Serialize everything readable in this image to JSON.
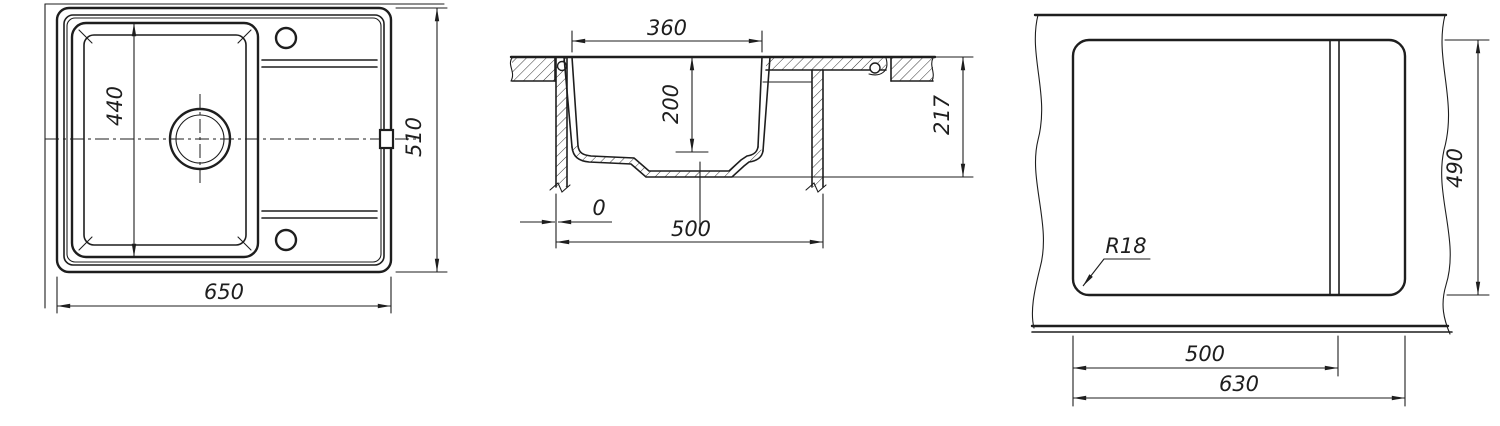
{
  "title": "Kitchen sink technical drawing - three views",
  "colors": {
    "ink": "#1e1e1e",
    "background": "#ffffff"
  },
  "views": {
    "top": {
      "label": "top-view",
      "dim_bowl_length": "440",
      "dim_overall_depth": "510",
      "dim_overall_width": "650"
    },
    "section": {
      "label": "section-view",
      "dim_bowl_opening": "360",
      "dim_bowl_depth": "200",
      "dim_total_height": "217",
      "dim_edge_offset": "0",
      "dim_base_width": "500"
    },
    "cutout": {
      "label": "cutout-view",
      "dim_corner_radius": "R18",
      "dim_cutout_depth": "490",
      "dim_cutout_width_main": "500",
      "dim_cutout_width_total": "630"
    }
  }
}
